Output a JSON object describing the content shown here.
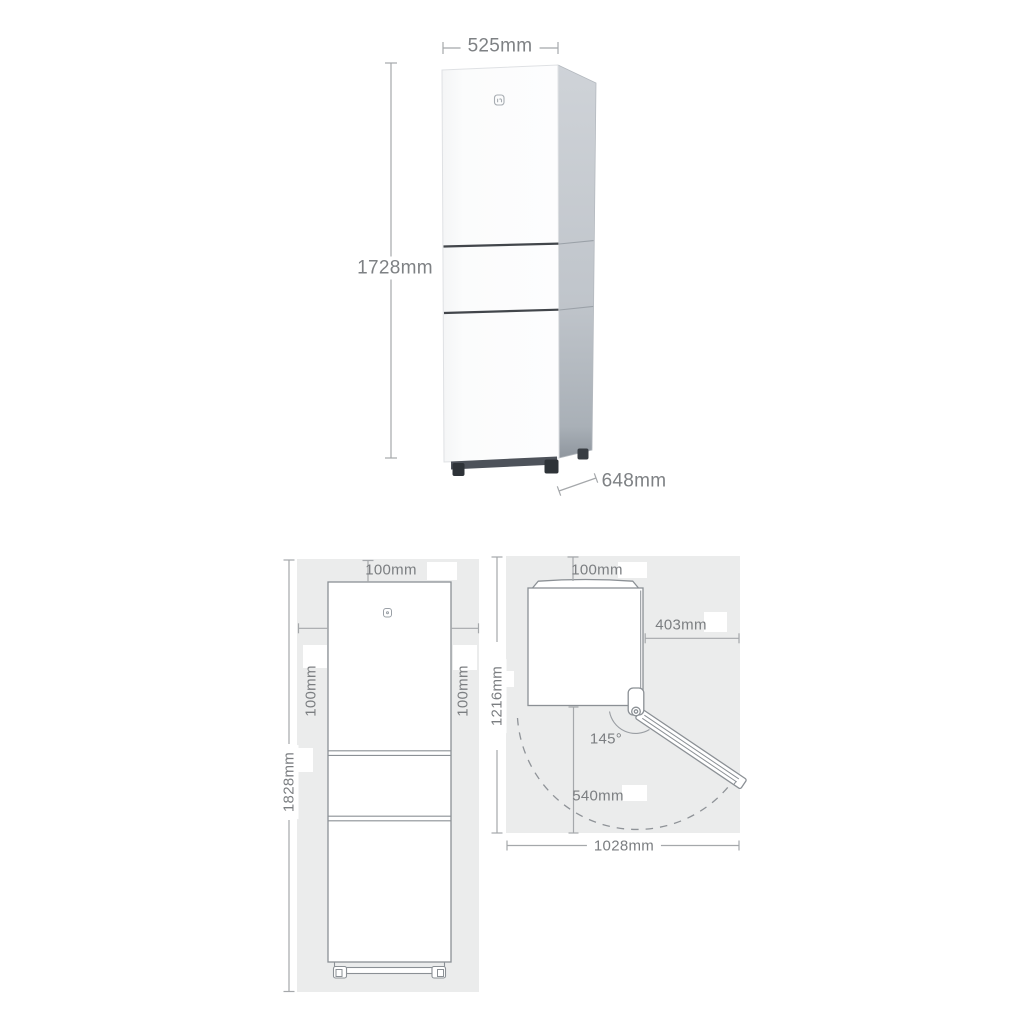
{
  "perspective_view": {
    "width": "525mm",
    "height": "1728mm",
    "depth": "648mm"
  },
  "front_clearance_view": {
    "top_clearance": "100mm",
    "left_clearance": "100mm",
    "right_clearance": "100mm",
    "overall_height": "1828mm"
  },
  "top_clearance_view": {
    "top_clearance": "100mm",
    "right_clearance": "403mm",
    "overall_depth": "1216mm",
    "door_open_angle": "145°",
    "door_swing_depth": "540mm",
    "overall_width": "1028mm"
  },
  "icons": {
    "brand_logo": "mijia-logo"
  },
  "colors": {
    "background": "#ffffff",
    "panel_background": "#ebecec",
    "dimension_line": "#a5a8ab",
    "dimension_text": "#7b7e81",
    "drawing_outline": "#8b9095",
    "fridge_side": "#c3c8cd",
    "fridge_divider": "#42464b",
    "fridge_feet": "#2e3338"
  }
}
